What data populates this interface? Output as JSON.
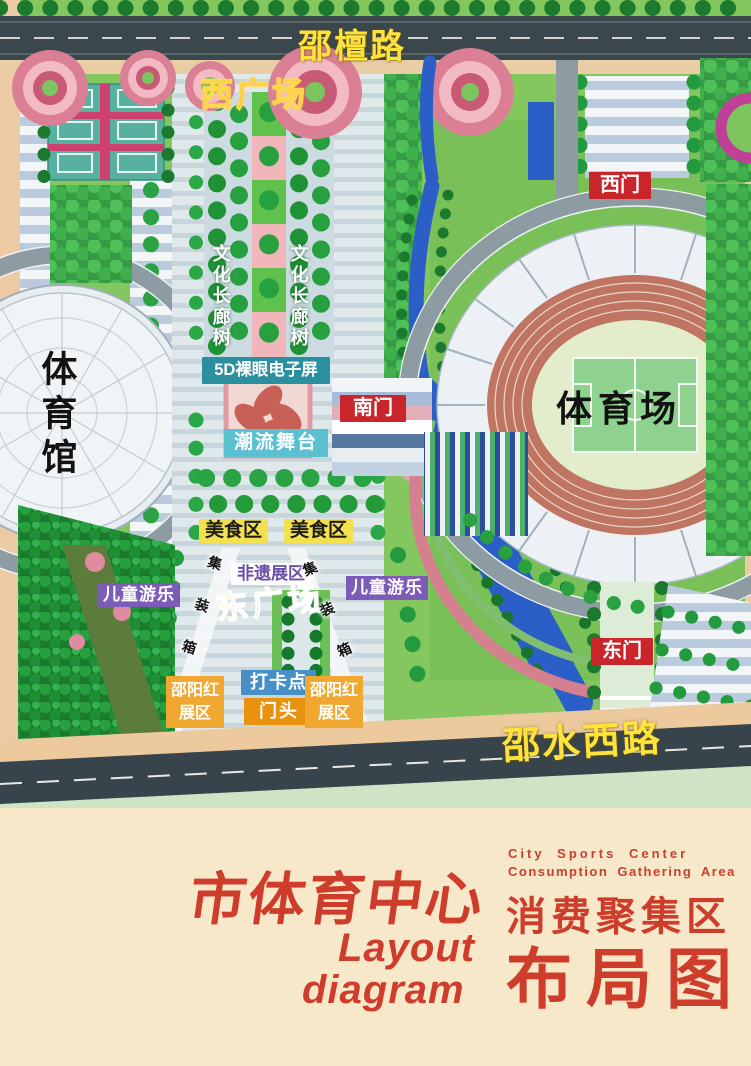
{
  "map": {
    "roads": {
      "north": "邵檀路",
      "south": "邵水西路"
    },
    "plazas": {
      "west": "西广场",
      "east": "东广场"
    },
    "gates": {
      "west": "西门",
      "south": "南门",
      "east": "东门"
    },
    "venues": {
      "stadium": "体育场",
      "gymnasium": "体育馆"
    },
    "features": {
      "culture_corridor_trees": "文化长廊树",
      "screen_5d": "5D裸眼电子屏",
      "trend_stage": "潮流舞台",
      "food_zone": "美食区",
      "heritage_zone": "非遗展区",
      "kids_play": "儿童游乐",
      "container": "集装箱",
      "checkin_point": "打卡点",
      "gate_head": "门头",
      "shaoyang_red_zone": "邵阳红展区"
    }
  },
  "title": {
    "cn_main": "市体育中心",
    "en_line1": "Layout",
    "en_line2": "diagram",
    "en_small_1": "City Sports Center",
    "en_small_2": "Consumption Gathering Area",
    "cn_sub": "消费聚集区",
    "cn_sub2": "布局图"
  },
  "colors": {
    "gate_badge_red": "#c9252b",
    "screen_badge_teal": "#2a8f9e",
    "stage_badge_cyan": "#5bc0cf",
    "food_badge_yellow": "#f2e14c",
    "kids_badge_purple": "#7d5cb8",
    "checkin_badge_blue": "#478fc9",
    "gatehead_badge_orange": "#e89210",
    "shaoyang_badge_amber": "#f0a830",
    "road_label_yellow": "#ffe23a",
    "title_red": "#ce3d2c",
    "background_cream": "#f8e8ca"
  }
}
